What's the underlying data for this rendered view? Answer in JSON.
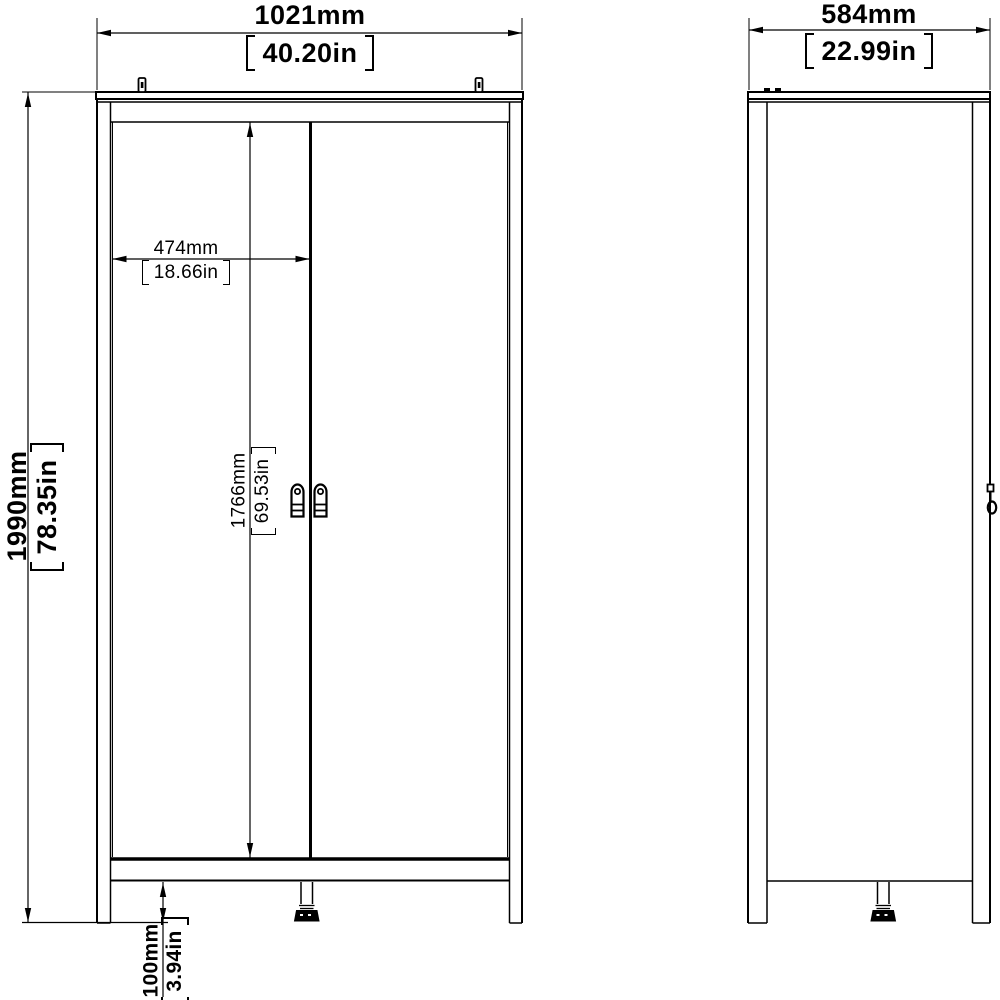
{
  "page": {
    "background": "#ffffff",
    "line_color": "#000000",
    "drawing_type": "wardrobe front and side elevation with dimensions"
  },
  "dimensions": {
    "overall_width": {
      "metric": "1021mm",
      "imperial": "40.20in"
    },
    "overall_depth": {
      "metric": "584mm",
      "imperial": "22.99in"
    },
    "overall_height": {
      "metric": "1990mm",
      "imperial": "78.35in"
    },
    "door_width": {
      "metric": "474mm",
      "imperial": "18.66in"
    },
    "door_height": {
      "metric": "1766mm",
      "imperial": "69.53in"
    },
    "leg_height": {
      "metric": "100mm",
      "imperial": "3.94in"
    }
  }
}
